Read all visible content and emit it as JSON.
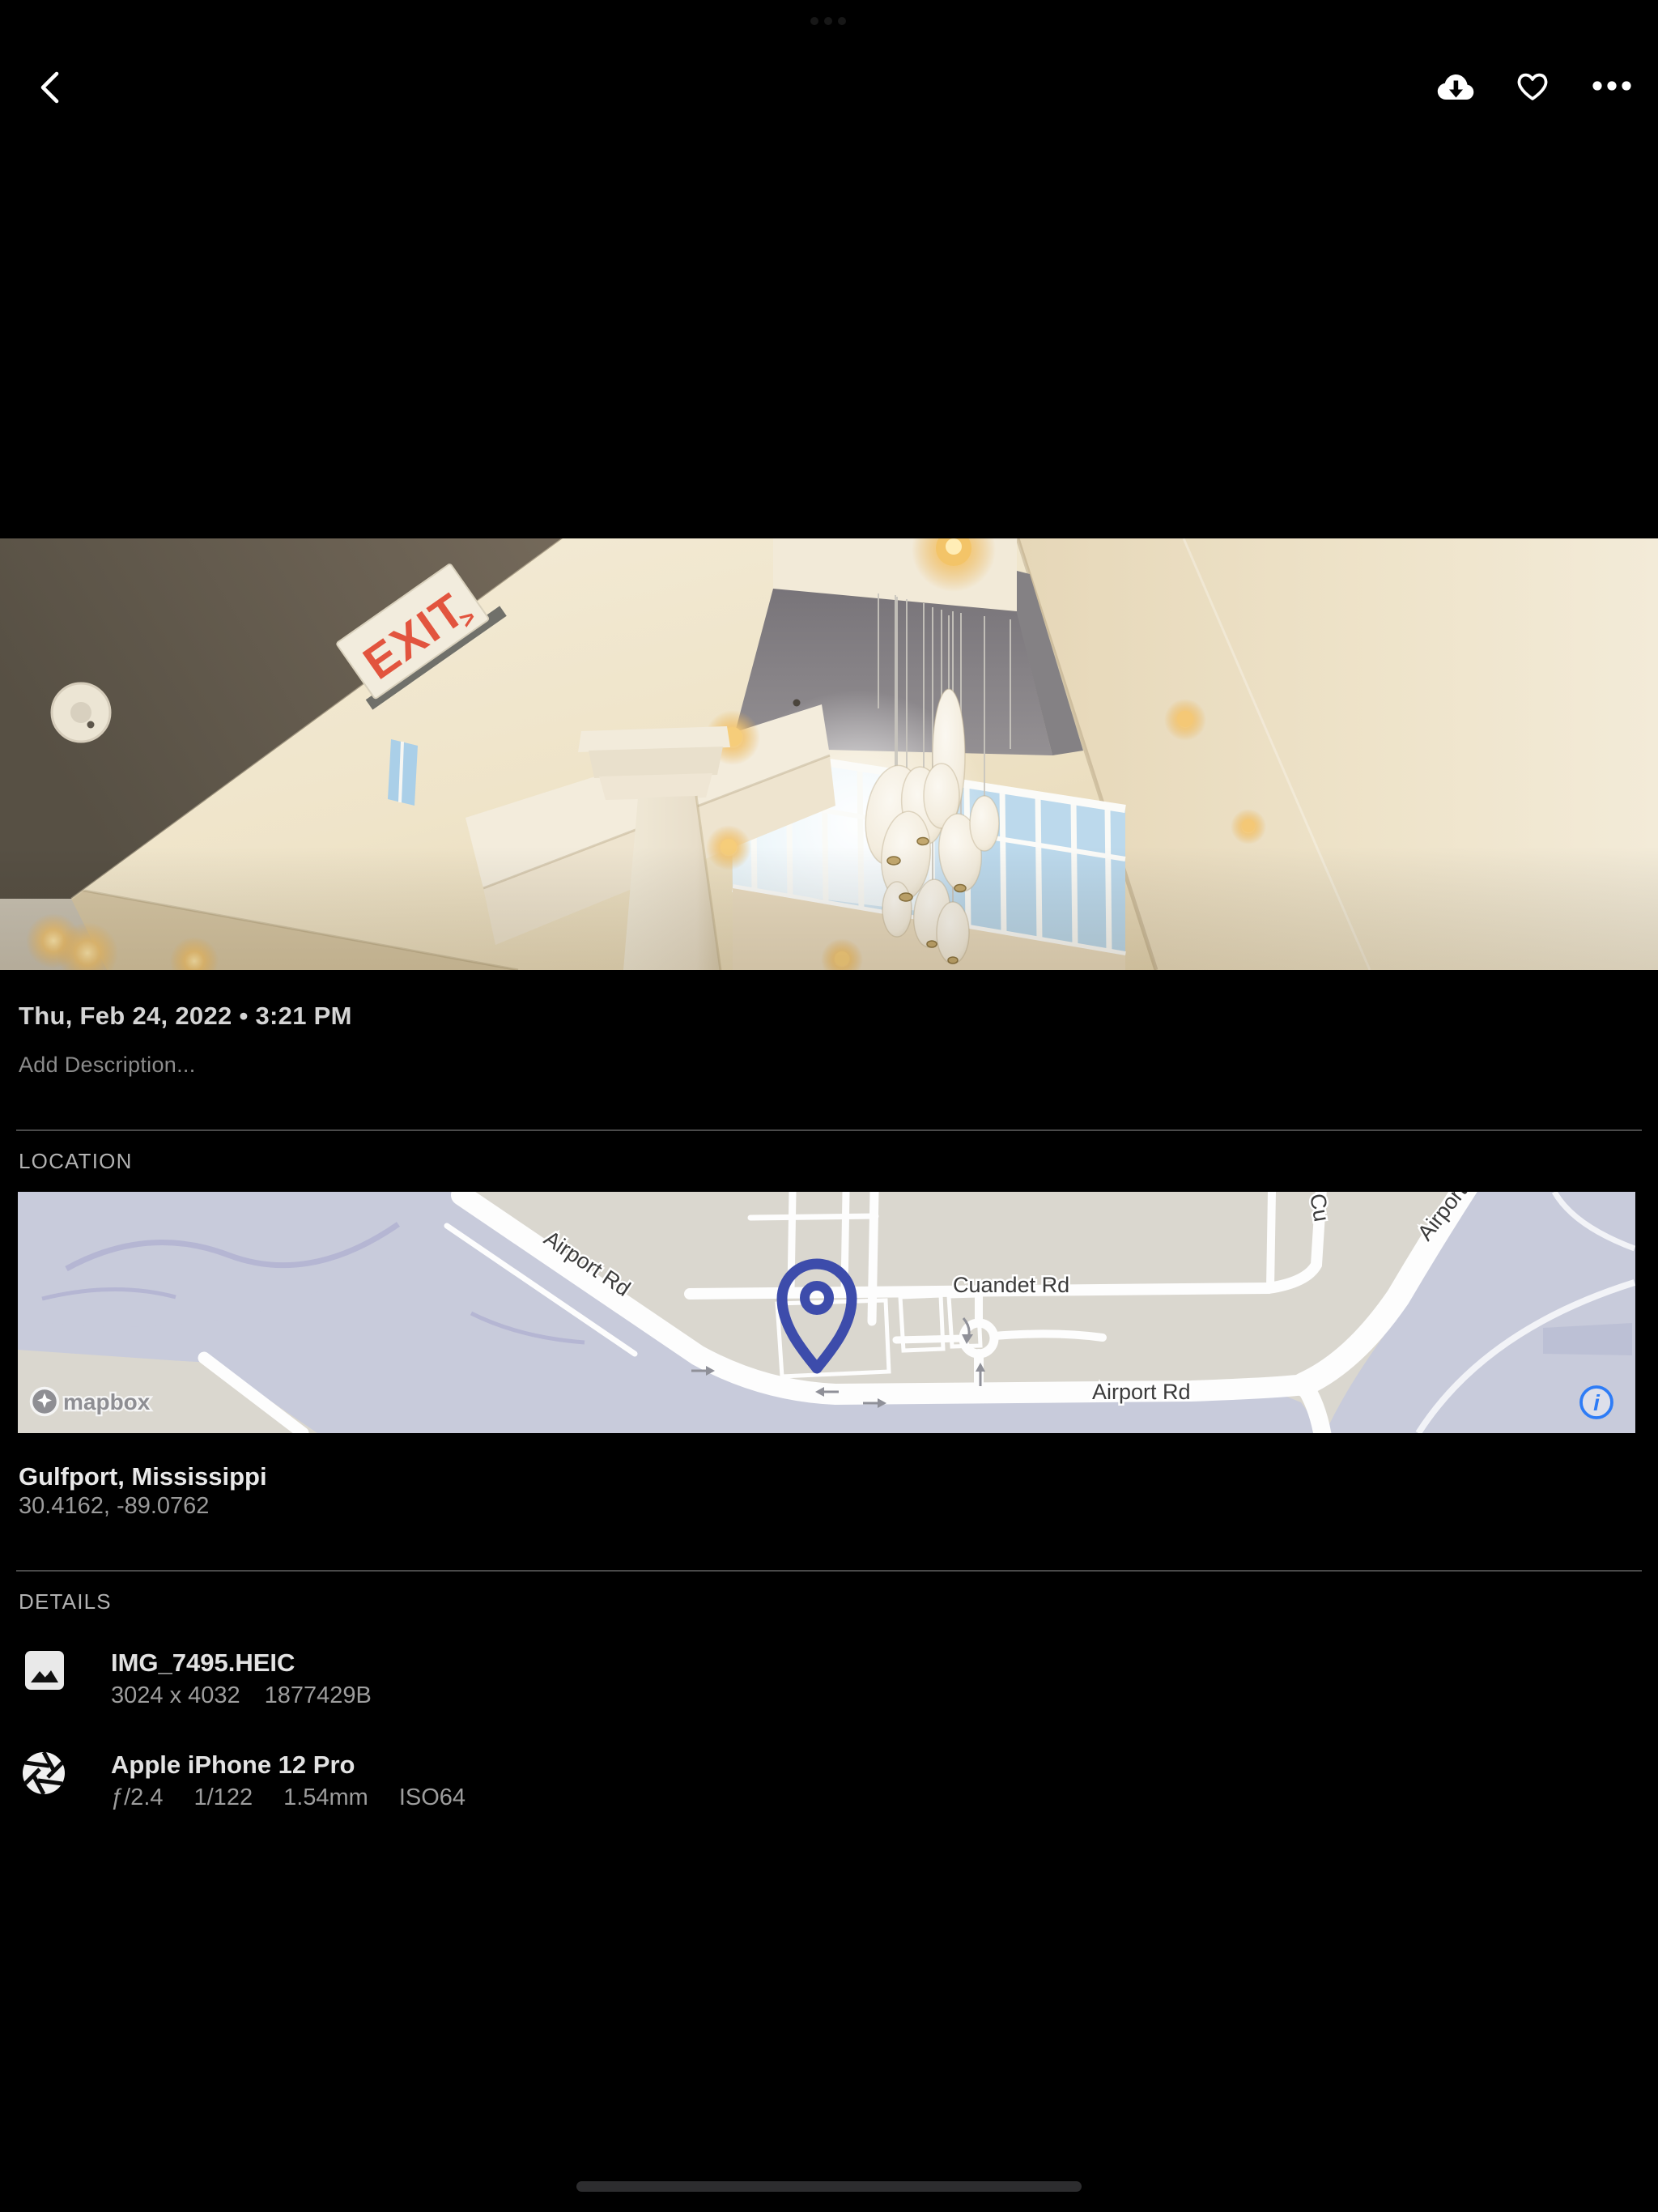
{
  "toolbar": {
    "back_icon": "chevron-left",
    "download_icon": "cloud-download",
    "favorite_icon": "heart",
    "more_icon": "ellipsis"
  },
  "photo": {
    "exit_text": "EXIT",
    "exit_arrow": ">"
  },
  "info": {
    "datetime": "Thu, Feb 24, 2022 • 3:21 PM",
    "description_placeholder": "Add Description...",
    "location": {
      "section_label": "LOCATION",
      "place": "Gulfport, Mississippi",
      "coordinates": "30.4162, -89.0762",
      "map": {
        "attribution": "mapbox",
        "info_glyph": "i",
        "pin_color": "#3d4cab",
        "info_color": "#2e7cf6",
        "labels": {
          "airport_rd_diagonal": "Airport Rd",
          "cuandet_rd": "Cuandet Rd",
          "airport_rd_horizontal": "Airport Rd",
          "airport_rd_top": "Airport Rd",
          "road_fragment_top": "Cu"
        }
      }
    },
    "details": {
      "section_label": "DETAILS",
      "file": {
        "name": "IMG_7495.HEIC",
        "dimensions": "3024 x 4032",
        "size": "1877429B"
      },
      "camera": {
        "name": "Apple iPhone 12 Pro",
        "aperture": "ƒ/2.4",
        "shutter": "1/122",
        "focal": "1.54mm",
        "iso": "ISO64"
      }
    }
  }
}
